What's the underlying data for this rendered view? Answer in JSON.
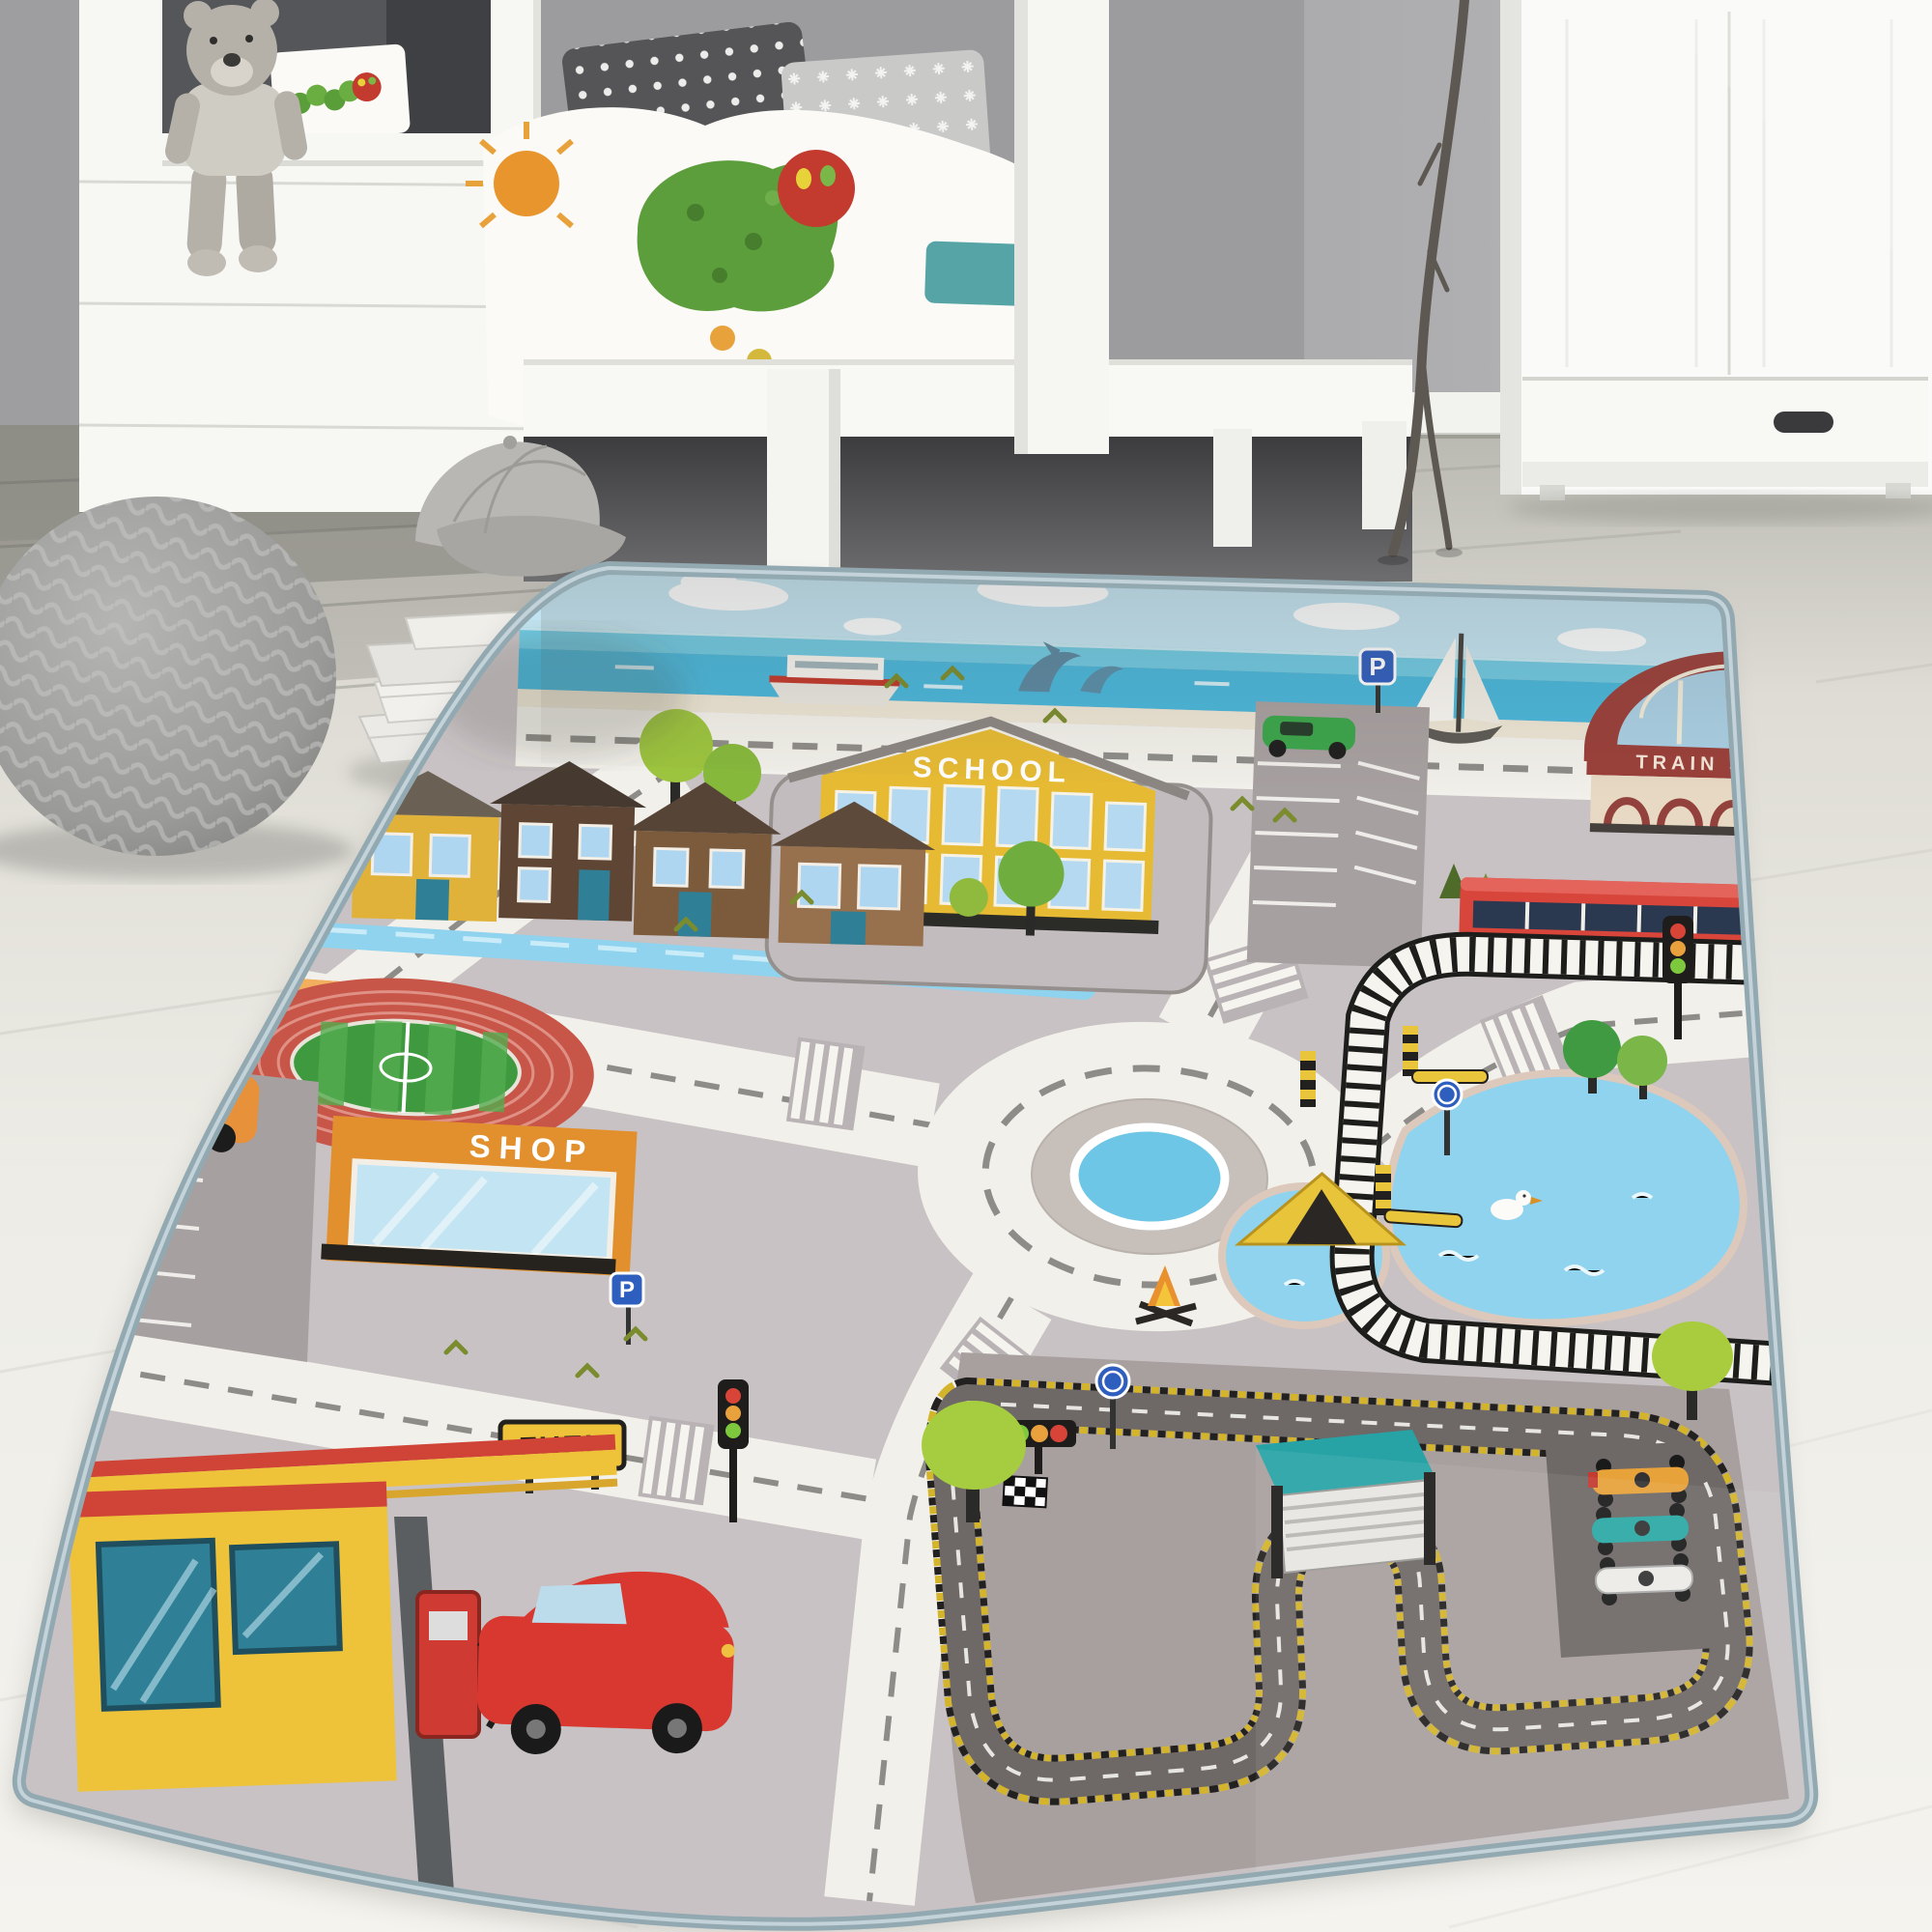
{
  "scene": {
    "type": "photograph",
    "subject": "children's city road play rug lying on whitewashed wood floor in a kids bedroom"
  },
  "room": {
    "wall_color": "#a8a8aa",
    "floor_color": "#edece6",
    "objects": [
      "white house-frame bunk bed",
      "teddy bear",
      "hungry-caterpillar bedding",
      "polka-dot pillow",
      "star pillow",
      "teal mattress",
      "white wardrobe with drawer",
      "decorative branch",
      "knitted gray pouf",
      "stack of books",
      "silver baseball cap"
    ]
  },
  "rug": {
    "binding_color": "#93a9b2",
    "base_color": "#c8c2c4",
    "labels": {
      "school": "SCHOOL",
      "train_station": "TRAIN STATION",
      "shop": "SHOP",
      "fuel": "FUEL",
      "parking_sign": "P",
      "parking_sign_2": "P"
    },
    "colors": {
      "road": "#f2f0ea",
      "road_dash": "#8e8c88",
      "sky": "#c2e4f2",
      "sea": "#49b6da",
      "beach": "#ece5d4",
      "lake": "#8fd3ee",
      "school_yellow": "#e6ba33",
      "station_red": "#9a3f3a",
      "train_red": "#d7453b",
      "shop_orange": "#e2902e",
      "fuel_yellow": "#eec33a",
      "race_track": "#6e6867",
      "race_ground": "#a8a09f",
      "hazard_yellow": "#d4b42a",
      "grass": "#3f9a3f",
      "track_red": "#c85648",
      "tree_green": "#9cc43e"
    },
    "features": [
      "sea with ferry, dolphins and sailboat",
      "coastal road",
      "school with schoolyard",
      "parking with green car",
      "train station with clock and red train",
      "railway line with level crossing",
      "roundabout with blue island",
      "row of houses",
      "river",
      "city bus",
      "athletics stadium",
      "shop",
      "parking lot with orange car",
      "fuel station with pump and red car",
      "lake with duck",
      "camping tent with campfire",
      "race circuit with start lights, pit garage and three race cars",
      "trees and birds",
      "traffic lights",
      "roundabout signs",
      "zebra crossings"
    ]
  }
}
